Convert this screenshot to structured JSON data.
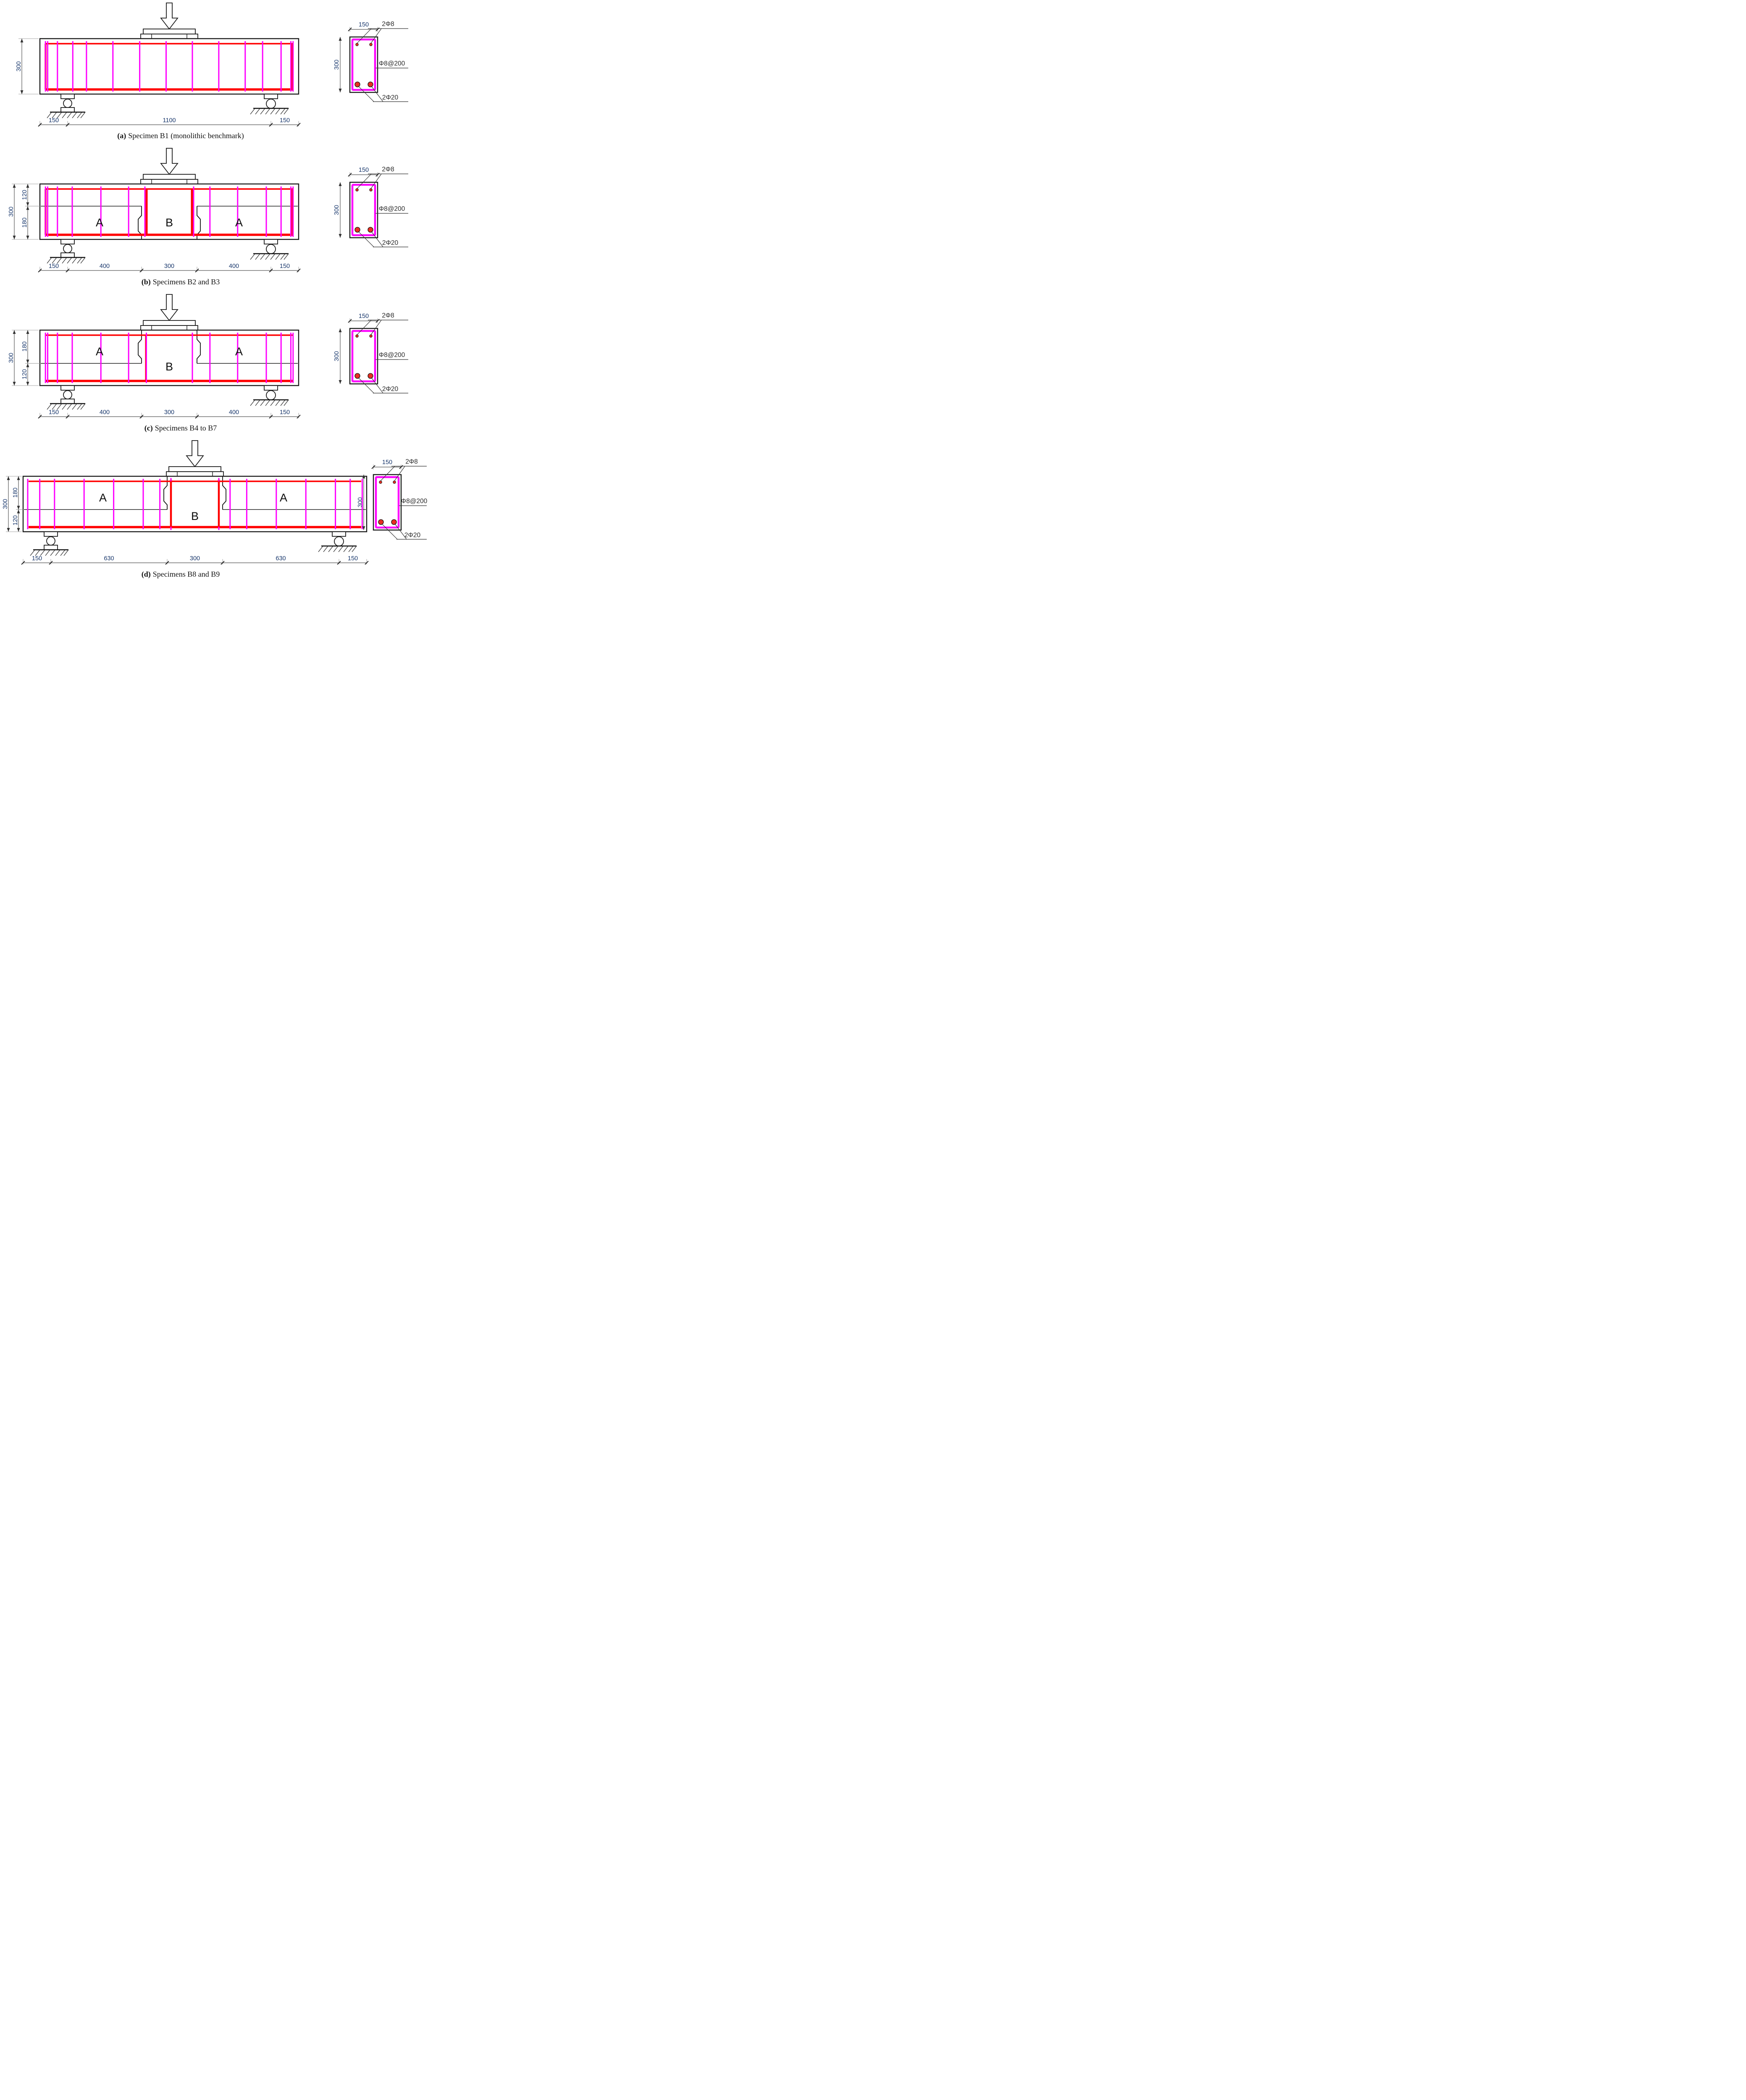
{
  "figure": {
    "captions": [
      {
        "label": "(a)",
        "text": "Specimen B1 (monolithic benchmark)"
      },
      {
        "label": "(b)",
        "text": "Specimens B2 and B3"
      },
      {
        "label": "(c)",
        "text": "Specimens B4 to B7"
      },
      {
        "label": "(d)",
        "text": "Specimens B8 and B9"
      }
    ]
  },
  "regions": {
    "a_label": "A",
    "b_label": "B"
  },
  "dims": {
    "beam_height": "300",
    "layers": {
      "b": {
        "top": "120",
        "bottom": "180"
      },
      "c": {
        "top": "180",
        "bottom": "120"
      },
      "d": {
        "top": "180",
        "bottom": "120"
      }
    },
    "bottom": {
      "a": [
        "150",
        "1100",
        "150"
      ],
      "b": [
        "150",
        "400",
        "300",
        "400",
        "150"
      ],
      "c": [
        "150",
        "400",
        "300",
        "400",
        "150"
      ],
      "d": [
        "150",
        "630",
        "300",
        "630",
        "150"
      ]
    }
  },
  "cross_section": {
    "width": "150",
    "height": "300",
    "top_bars": "2Φ8",
    "stirrups": "Φ8@200",
    "bottom_bars": "2Φ20"
  },
  "colors": {
    "stirrup": "#ff00ff",
    "rebar": "#ff0000",
    "outline": "#1a1a1a"
  }
}
